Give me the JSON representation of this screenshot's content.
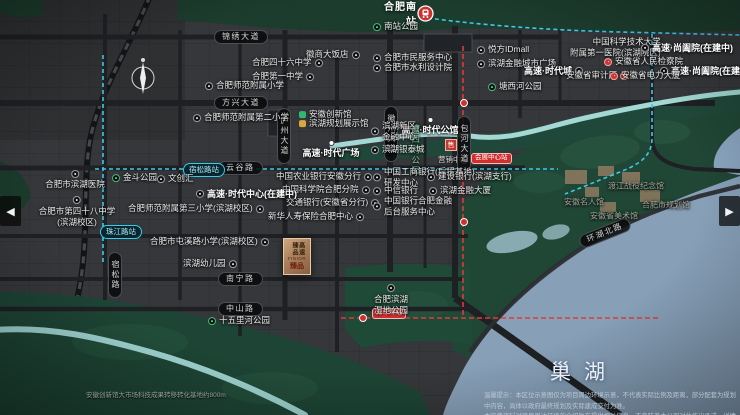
{
  "nav": {
    "prev": "◀",
    "next": "▶"
  },
  "map": {
    "station_hfnz": "合肥南站",
    "lake_label": "巢湖",
    "sales_glyph": "售",
    "sales_caption": "营销中心",
    "logo": {
      "vertical": "高速臻品",
      "latin": "FINIOR",
      "cn": "臻品"
    },
    "note_left": "安徽创新馆大市场科技成果转移转化基地约800m",
    "disclaimer1": "温馨提示：本区位示意图仅为项目周边环境示意，不代表实际比例及距离，部分配套为规划中内容，具体以政府最终规划及实际建成交付为准。",
    "disclaimer2": "本宣传资料对项目周边环境的介绍旨在提供相关信息，不意味着本公司对此作出承诺，详情请见商品房买卖合同。",
    "road_labels": [
      {
        "t": "锦绣大道",
        "x": 214,
        "y": 30,
        "v": 0
      },
      {
        "t": "方兴大道",
        "x": 214,
        "y": 96,
        "v": 0
      },
      {
        "t": "云谷路",
        "x": 218,
        "y": 161,
        "v": 0
      },
      {
        "t": "南宁路",
        "x": 218,
        "y": 272,
        "v": 0
      },
      {
        "t": "中山路",
        "x": 218,
        "y": 302,
        "v": 0
      },
      {
        "t": "宿松路",
        "x": 108,
        "y": 252,
        "v": 1
      },
      {
        "t": "庐州大道",
        "x": 277,
        "y": 108,
        "v": 1
      },
      {
        "t": "徽州大道",
        "x": 384,
        "y": 106,
        "v": 1
      },
      {
        "t": "包河大道",
        "x": 457,
        "y": 116,
        "v": 1
      },
      {
        "t": "环湖北路",
        "x": 578,
        "y": 226,
        "v": 0,
        "rot": -22
      }
    ],
    "stations": [
      {
        "kind": "blue",
        "t": "宿松路站",
        "x": 183,
        "y": 163
      },
      {
        "kind": "blue",
        "t": "珠江路站",
        "x": 100,
        "y": 225
      },
      {
        "kind": "red",
        "t": "会展中心站",
        "x": 471,
        "y": 153
      },
      {
        "kind": "red",
        "t": "万年埠站",
        "x": 372,
        "y": 308
      }
    ],
    "metro_icons": [
      [
        464,
        103
      ],
      [
        464,
        160
      ],
      [
        464,
        222
      ],
      [
        363,
        318
      ]
    ],
    "pois": [
      {
        "k": "park",
        "t": "南站公园",
        "x": 373,
        "y": 27,
        "side": "l"
      },
      {
        "k": "poi",
        "t": "合肥市民服务中心",
        "x": 373,
        "y": 58,
        "side": "l"
      },
      {
        "k": "poi",
        "t": "合肥市水利设计院",
        "x": 373,
        "y": 68,
        "side": "l"
      },
      {
        "k": "poi",
        "t": "悦方IDmall",
        "x": 477,
        "y": 50,
        "side": "l"
      },
      {
        "k": "poi",
        "t": "滨湖金融城市广场",
        "x": 477,
        "y": 64,
        "side": "l"
      },
      {
        "k": "bold",
        "t": "高速·时代城",
        "x": 524,
        "y": 71,
        "side": "r"
      },
      {
        "k": "poi",
        "lines": [
          "中国科学技术大学",
          "附属第一医院(滨湖院区)"
        ],
        "x": 570,
        "y": 47,
        "side": "r"
      },
      {
        "k": "bold",
        "t": "高速·尚阖院(在建中)",
        "x": 641,
        "y": 48,
        "side": "l"
      },
      {
        "k": "bold",
        "t": "高速·尚阖院(在建中)",
        "x": 660,
        "y": 71,
        "side": "l"
      },
      {
        "k": "red",
        "t": "安徽省人民检察院",
        "x": 604,
        "y": 62,
        "side": "l"
      },
      {
        "k": "red",
        "t": "安徽省审计厅",
        "x": 566,
        "y": 76,
        "side": "r"
      },
      {
        "k": "red",
        "t": "安徽省电力大厦",
        "x": 610,
        "y": 76,
        "side": "l"
      },
      {
        "k": "park",
        "t": "塘西河公园",
        "x": 488,
        "y": 87,
        "side": "l"
      },
      {
        "k": "poi",
        "t": "徽商大饭店",
        "x": 306,
        "y": 55,
        "side": "r"
      },
      {
        "k": "poi",
        "t": "合肥四十六中学",
        "x": 252,
        "y": 63,
        "side": "r"
      },
      {
        "k": "poi",
        "t": "合肥第一中学",
        "x": 252,
        "y": 77,
        "side": "r"
      },
      {
        "k": "poi",
        "t": "合肥师范附属小学",
        "x": 205,
        "y": 86,
        "side": "l"
      },
      {
        "k": "poi",
        "t": "合肥师范附属第二小学",
        "x": 193,
        "y": 118,
        "side": "l"
      },
      {
        "k": "logo-green",
        "t": "安徽创新馆",
        "x": 299,
        "y": 115
      },
      {
        "k": "logo-gold",
        "t": "滨湖规划展示馆",
        "x": 299,
        "y": 124
      },
      {
        "k": "bold-dot",
        "t": "高速·时代广场",
        "x": 331,
        "y": 140
      },
      {
        "k": "bold-dot",
        "t": "高速·时代公馆",
        "x": 430,
        "y": 117
      },
      {
        "k": "parkvert",
        "t": "塘西河公园",
        "x": 410,
        "y": 124
      },
      {
        "k": "poi",
        "lines": [
          "滨湖新区",
          "金融中心"
        ],
        "x": 371,
        "y": 131,
        "side": "l"
      },
      {
        "k": "poi",
        "t": "滨湖银泰城",
        "x": 371,
        "y": 150,
        "side": "l"
      },
      {
        "k": "poi",
        "t": "中国农业银行安徽分行",
        "x": 276,
        "y": 177,
        "side": "r"
      },
      {
        "k": "poi",
        "t": "中国科学院合肥分院",
        "x": 282,
        "y": 190,
        "side": "r"
      },
      {
        "k": "poi",
        "t": "交通银行(安徽省分行)",
        "x": 286,
        "y": 203,
        "side": "r"
      },
      {
        "k": "poi",
        "t": "新华人寿保险合肥中心",
        "x": 268,
        "y": 217,
        "side": "r"
      },
      {
        "k": "poi",
        "lines": [
          "中国工商银行(后援基地)",
          "研发中心"
        ],
        "x": 373,
        "y": 177,
        "side": "l"
      },
      {
        "k": "poi",
        "t": "中信银行",
        "x": 373,
        "y": 191,
        "side": "l"
      },
      {
        "k": "poi",
        "lines": [
          "中国银行合肥金融",
          "后台服务中心"
        ],
        "x": 373,
        "y": 206,
        "side": "l"
      },
      {
        "k": "poi",
        "t": "建设银行(滨湖支行)",
        "x": 427,
        "y": 177,
        "side": "l"
      },
      {
        "k": "poi",
        "t": "滨湖金融大厦",
        "x": 429,
        "y": 191,
        "side": "l"
      },
      {
        "k": "park",
        "t": "金斗公园",
        "x": 112,
        "y": 178,
        "side": "l"
      },
      {
        "k": "poi",
        "t": "文创汇",
        "x": 157,
        "y": 179,
        "side": "l"
      },
      {
        "k": "poit",
        "t": "合肥市滨湖医院",
        "x": 75,
        "y": 170
      },
      {
        "k": "poit",
        "lines": [
          "合肥市第四十八中学",
          "(滨湖校区)"
        ],
        "x": 77,
        "y": 196
      },
      {
        "k": "poi",
        "t": "合肥师范附属第三小学(滨湖校区)",
        "x": 128,
        "y": 209,
        "side": "r"
      },
      {
        "k": "bold",
        "t": "高速·时代中心(在建中)",
        "x": 196,
        "y": 194,
        "side": "l"
      },
      {
        "k": "poi",
        "t": "合肥市屯溪路小学(滨湖校区)",
        "x": 150,
        "y": 242,
        "side": "r"
      },
      {
        "k": "poi",
        "t": "滨湖幼儿园",
        "x": 183,
        "y": 264,
        "side": "r"
      },
      {
        "k": "poit",
        "lines": [
          "合肥滨湖",
          "湿地公园"
        ],
        "x": 391,
        "y": 284
      },
      {
        "k": "park",
        "t": "十五里河公园",
        "x": 208,
        "y": 321,
        "side": "l"
      },
      {
        "k": "gray",
        "t": "渡江战役纪念馆",
        "x": 608,
        "y": 186
      },
      {
        "k": "gray",
        "t": "安徽名人馆",
        "x": 564,
        "y": 202
      },
      {
        "k": "gray",
        "t": "安徽省美术馆",
        "x": 590,
        "y": 216
      },
      {
        "k": "gray",
        "t": "合肥市规划馆",
        "x": 642,
        "y": 205
      }
    ]
  }
}
